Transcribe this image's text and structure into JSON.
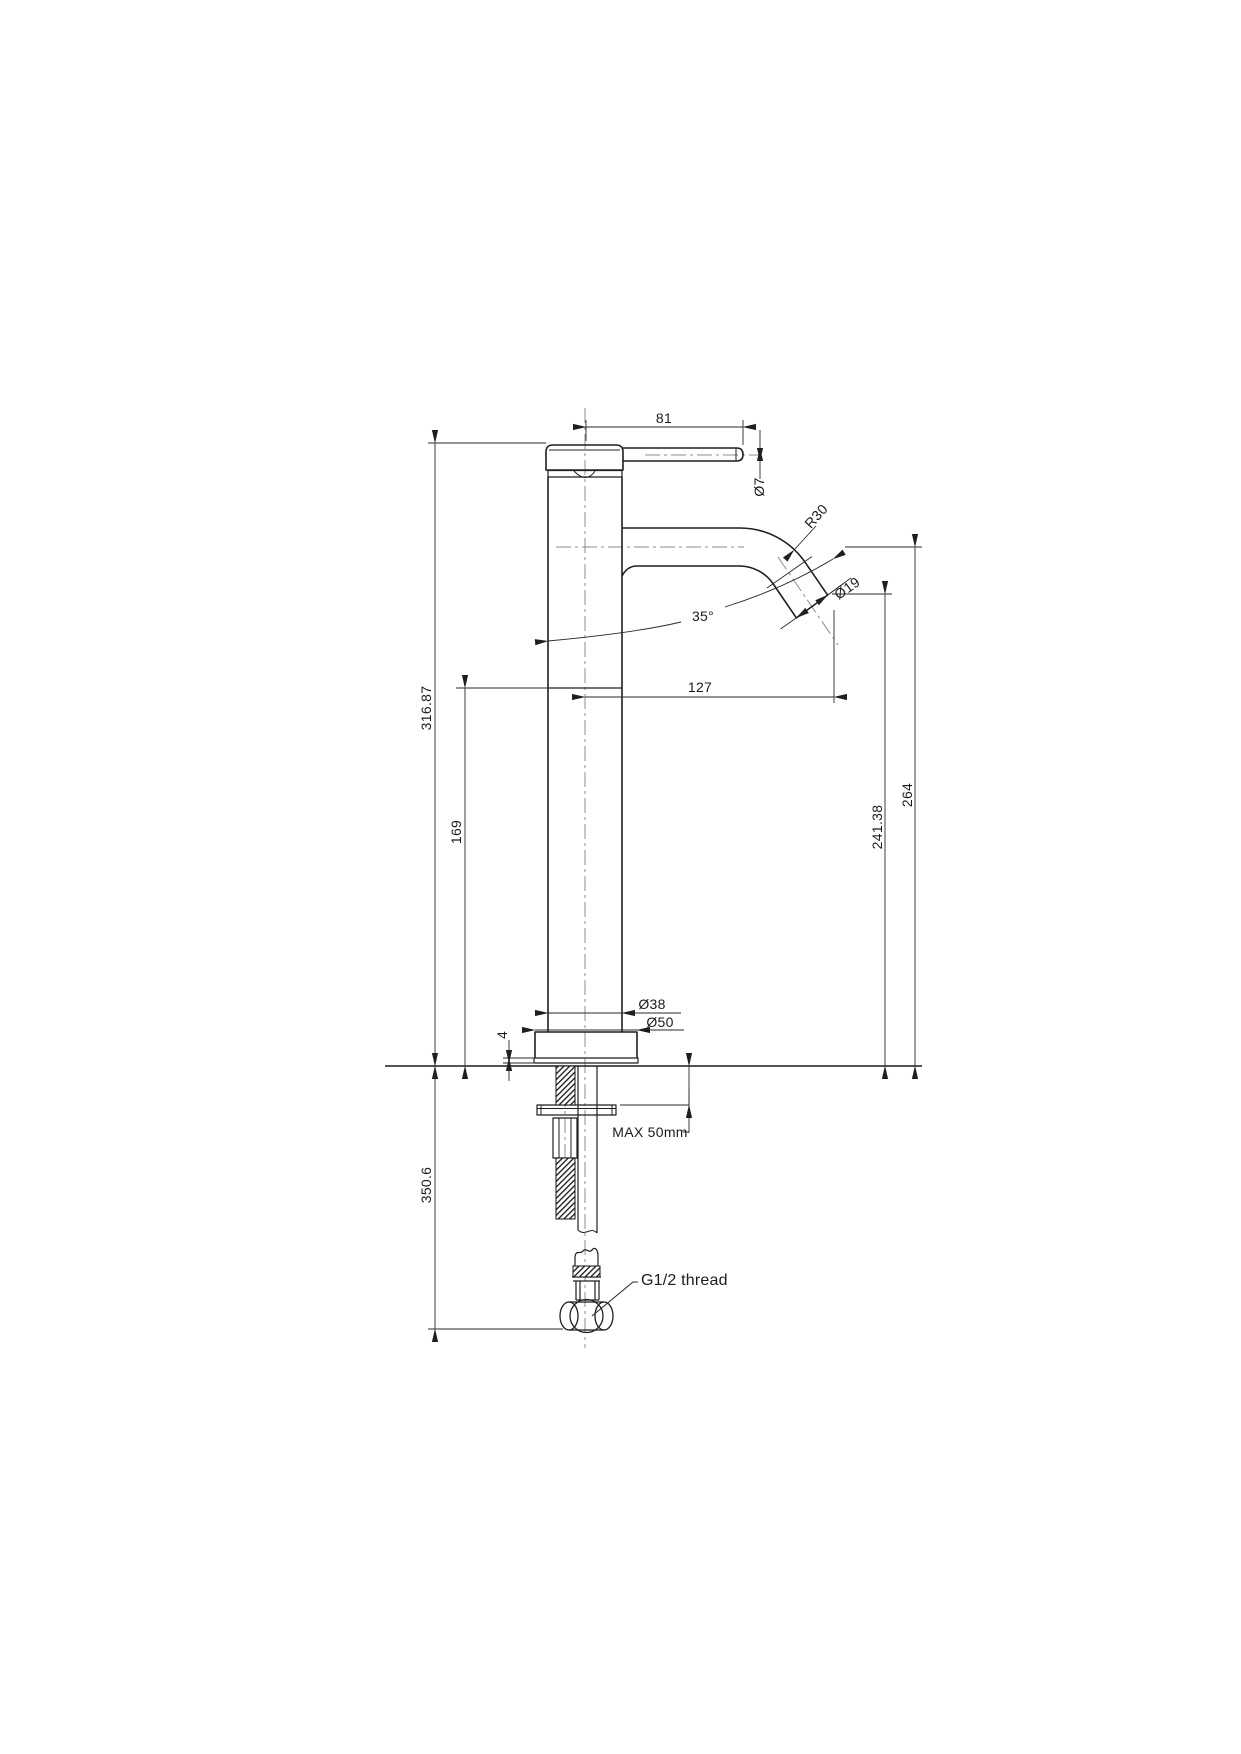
{
  "drawing": {
    "type": "faucet technical drawing",
    "dims": {
      "lever_length": "81",
      "lever_diameter": "Ø7",
      "spout_bend_radius": "R30",
      "spout_tube_diameter": "Ø19",
      "spout_angle": "35°",
      "spout_reach": "127",
      "height_overall_above_deck": "316.87",
      "height_upper_body": "169",
      "height_spout_outlet": "241.38",
      "height_spout_centre": "264",
      "body_diameter": "Ø38",
      "base_diameter": "Ø50",
      "base_plate_thickness": "4",
      "max_deck_thickness": "MAX 50mm",
      "height_below_deck_overall": "350.6",
      "thread_note": "G1/2 thread"
    },
    "colors": {
      "outline": "#1f1f1f",
      "dimension_line": "#2a2a2a",
      "centerline": "#8c8c8c",
      "background": "#ffffff"
    }
  }
}
